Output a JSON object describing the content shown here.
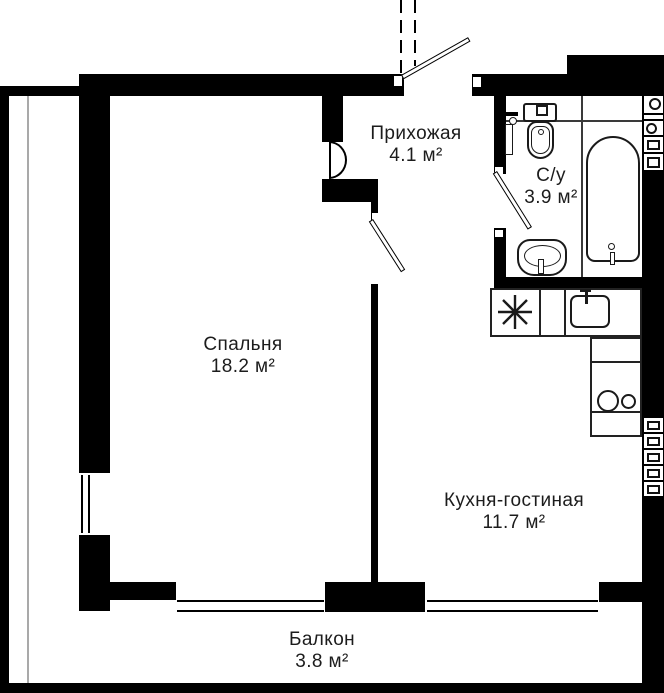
{
  "plan_title": "Floor plan",
  "rooms": [
    {
      "name": "Прихожая",
      "area": "4.1 м²"
    },
    {
      "name": "С/у",
      "area": "3.9 м²"
    },
    {
      "name": "Спальня",
      "area": "18.2 м²"
    },
    {
      "name": "Кухня-гостиная",
      "area": "11.7 м²"
    },
    {
      "name": "Балкон",
      "area": "3.8 м²"
    }
  ],
  "fixtures": [
    "entrance-door",
    "bathroom-door",
    "interior-door",
    "toilet",
    "towel-rail",
    "bathtub",
    "bathroom-sink",
    "kitchen-sink",
    "fridge",
    "stove-burners",
    "bedroom-window",
    "balcony-windows",
    "ventilation-blocks"
  ],
  "colors": {
    "wall": "#000000",
    "fixture_line": "#1a1a1a",
    "text": "#1c1c1c",
    "background": "#ffffff"
  }
}
